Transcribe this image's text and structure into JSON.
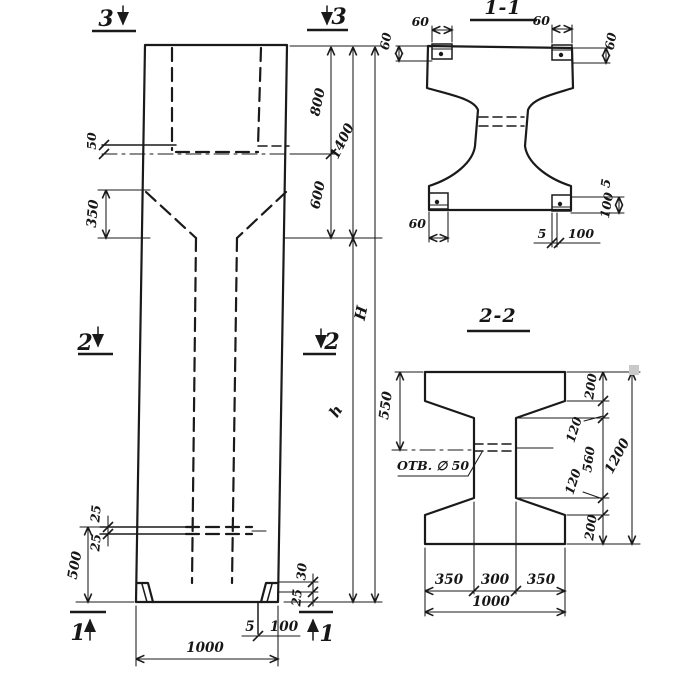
{
  "colors": {
    "ink": "#1a1a1a",
    "paper": "#ffffff",
    "artifact": "#c9c9c9"
  },
  "main_view": {
    "markers": {
      "top_left": "3",
      "top_right": "3",
      "mid_left": "2",
      "mid_right": "2",
      "bot_left": "1",
      "bot_right": "1"
    },
    "dims": {
      "d50": "50",
      "d350": "350",
      "d800": "800",
      "d1400": "1400",
      "d600": "600",
      "H": "H",
      "h": "h",
      "d25a": "25",
      "d25b": "25",
      "d500": "500",
      "d30": "30",
      "d25c": "25",
      "d5": "5",
      "d100": "100",
      "d1000": "1000"
    }
  },
  "section11": {
    "title": "1-1",
    "dims": {
      "tl60": "60",
      "tlv60": "60",
      "tr60": "60",
      "trv60": "60",
      "bl60": "60",
      "b5": "5",
      "b100": "100",
      "r5": "5",
      "r100": "100"
    }
  },
  "section22": {
    "title": "2-2",
    "hole": "ОТВ. ∅ 50",
    "dims": {
      "d200t": "200",
      "d120t": "120",
      "d560": "560",
      "d120b": "120",
      "d200b": "200",
      "d1200": "1200",
      "d550": "550",
      "d350l": "350",
      "d300": "300",
      "d350r": "350",
      "d1000": "1000"
    }
  }
}
